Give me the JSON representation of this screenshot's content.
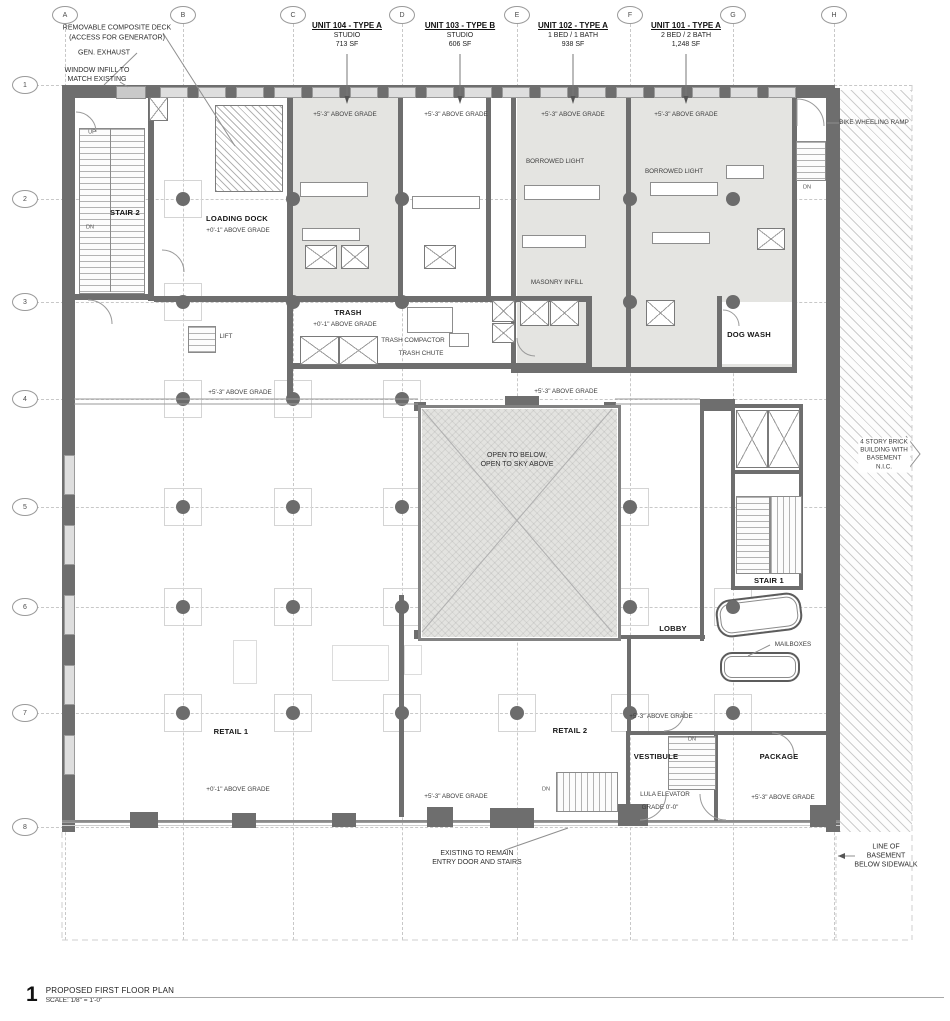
{
  "sheet": {
    "number": "1",
    "title": "PROPOSED FIRST FLOOR PLAN",
    "scale": "SCALE:  1/8\" = 1'-0\""
  },
  "grid": {
    "columns": [
      "A",
      "B",
      "C",
      "D",
      "E",
      "F",
      "G",
      "H"
    ],
    "rows": [
      "1",
      "2",
      "3",
      "4",
      "5",
      "6",
      "7",
      "8"
    ]
  },
  "units": [
    {
      "name": "UNIT 104 - TYPE A",
      "desc": "STUDIO",
      "area": "713 SF"
    },
    {
      "name": "UNIT 103 - TYPE B",
      "desc": "STUDIO",
      "area": "606 SF"
    },
    {
      "name": "UNIT 102 - TYPE A",
      "desc": "1 BED / 1 BATH",
      "area": "938 SF"
    },
    {
      "name": "UNIT 101 - TYPE A",
      "desc": "2 BED / 2 BATH",
      "area": "1,248 SF"
    }
  ],
  "rooms": {
    "stair2": "STAIR 2",
    "loading_dock": "LOADING DOCK",
    "trash": "TRASH",
    "trash_compactor": "TRASH COMPACTOR",
    "trash_chute": "TRASH CHUTE",
    "lift": "LIFT",
    "dog_wash": "DOG WASH",
    "lobby": "LOBBY",
    "stair1": "STAIR 1",
    "retail1": "RETAIL 1",
    "retail2": "RETAIL 2",
    "vestibule": "VESTIBULE",
    "package": "PACKAGE",
    "lula_elevator": "LULA ELEVATOR",
    "lula_grade": "GRADE 0'-0\""
  },
  "grades": {
    "plus_5_3": "+5'-3\" ABOVE GRADE",
    "plus_0_1": "+0'-1\" ABOVE GRADE"
  },
  "annotations": {
    "removable_deck": "REMOVABLE COMPOSITE DECK",
    "removable_deck_sub": "(ACCESS FOR GENERATOR)",
    "gen_exhaust": "GEN. EXHAUST",
    "window_infill": "WINDOW INFILL TO\nMATCH EXISTING",
    "borrowed_light": "BORROWED LIGHT",
    "masonry_infill": "MASONRY INFILL",
    "open_to_below": "OPEN TO BELOW,\nOPEN TO SKY ABOVE",
    "bike_ramp": "BIKE WHEELING RAMP",
    "brick_building": "4 STORY BRICK\nBUILDING WITH\nBASEMENT\nN.I.C.",
    "mailboxes": "MAILBOXES",
    "existing_entry": "EXISTING TO REMAIN\nENTRY DOOR AND STAIRS",
    "basement_line": "LINE OF BASEMENT\nBELOW SIDEWALK"
  },
  "stairs": {
    "up": "UP",
    "dn": "DN"
  },
  "colors": {
    "wall": "#6e6e6e",
    "unit_fill": "#e4e4e1",
    "hatch_line": "#cdcdcd",
    "text": "#2e2e2e"
  }
}
